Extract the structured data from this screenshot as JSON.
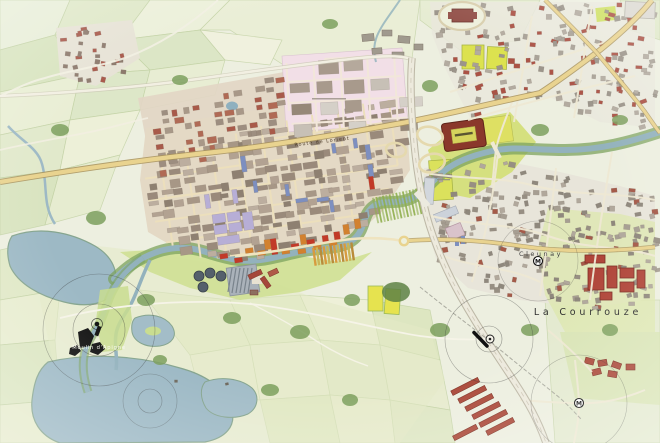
{
  "map": {
    "type": "urban-masterplan-map",
    "labels": {
      "route_de_lorient": "Route de Lorient",
      "cleunay": "Cleunay",
      "la_courrouze": "La Courrouze",
      "moulin_apigne": "Moulin d'Apigné"
    },
    "markers": {
      "metro_label": "M"
    },
    "colors": {
      "water": "#9db9c5",
      "meadow_green": "#cfe093",
      "field_green": "#e4ebcf",
      "road_yellow": "#e9d38f",
      "urban_plate": "#e4d9c5",
      "pink_district": "#f2dfe7",
      "accent_red": "#c23a28",
      "accent_orange": "#d2812f",
      "accent_blue": "#7d8fc0",
      "accent_lavender": "#b7aed6",
      "stadium_red": "#8a382b",
      "roof_red": "#ab4a3a"
    }
  }
}
